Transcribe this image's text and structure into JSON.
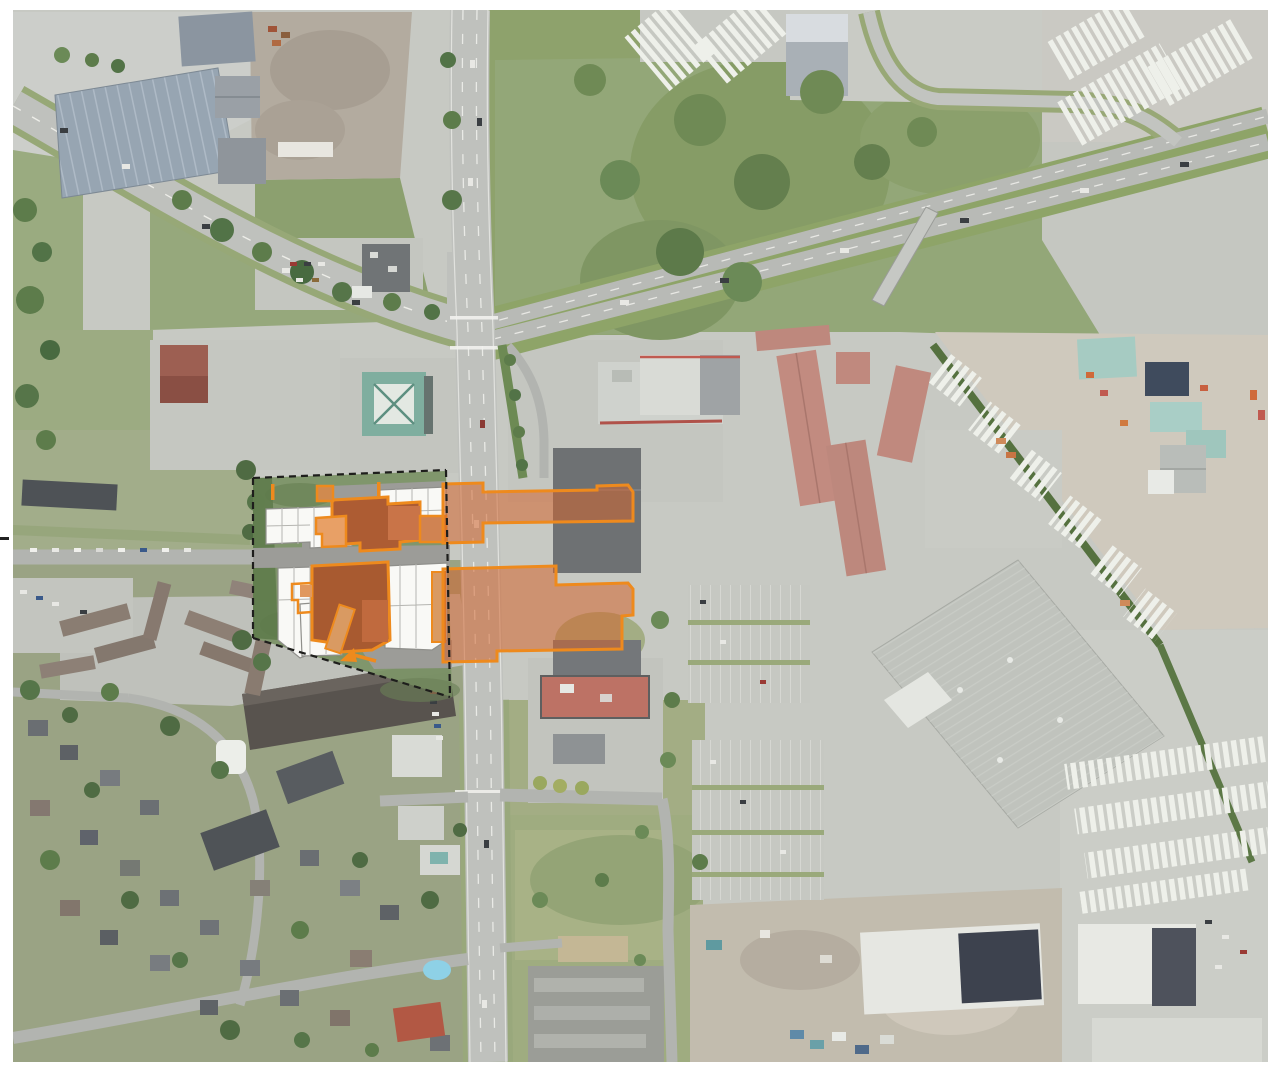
{
  "meta": {
    "description": "Aerial photograph of a suburban arterial corridor with an architectural site-plan overlay: a dashed black site boundary on the west side of a north-south boulevard containing white proposed buildings on a green landscaped site with dark terracotta building masses outlined in orange, plus two semi-transparent orange impact overlays extending east across the boulevard over existing commercial buildings, and an orange locator arrow.",
    "image_type": "aerial-site-plan-composite",
    "visible_text": "none"
  },
  "frame": {
    "margin_color": "#ffffff",
    "photo_area": {
      "x": 13,
      "y": 10,
      "width": 1255,
      "height": 1052
    },
    "crop_mark": {
      "position": "left-edge",
      "color": "#222222"
    }
  },
  "palette": {
    "photo_base": "#c7c9c3",
    "road_asphalt": "#bfc1bd",
    "highway_asphalt": "#b8bab6",
    "lane_marking": "#f4f4f0",
    "green_field": "#93a778",
    "green_scrub": "#859c69",
    "tree_dark": "#5d7a4a",
    "dirt_lot": "#b3ab9f",
    "concrete_yard": "#cfc9bd",
    "roof_red": "#c28b80",
    "roof_dark": "#6e7173",
    "roof_blue_gray": "#97a5b2",
    "roof_teal": "#7fae9f",
    "warehouse_gray": "#c0c3bd",
    "white_roof": "#e8e9e4",
    "residential_roof": "#8a7d72",
    "big_box_red": "#bd7265",
    "pool_blue": "#8ed1e6"
  },
  "site_overlay": {
    "outline_color": "#ee8a1d",
    "boundary_color": "#1e1e1c",
    "boundary_style": "dashed",
    "lawn_color": "#7c9367",
    "drive_color": "#9c9c98",
    "building_white": "#f9f9f6",
    "mass_dark": "#ad5c33",
    "mass_medium": "#c97448",
    "mass_light": "#d99a62",
    "impact_fill": "#d2642d",
    "impact_opacity": 0.55,
    "elements": [
      "site-boundary-dashed",
      "site-lawn",
      "internal-drives",
      "proposed-building-northwest",
      "proposed-building-northeast",
      "proposed-building-southwest",
      "proposed-building-southeast",
      "terracotta-mass-north",
      "terracotta-mass-south",
      "impact-overlay-north",
      "impact-overlay-south",
      "overlay-arrow"
    ]
  },
  "scene_features": [
    "curved-arterial-northwest",
    "north-south-boulevard",
    "divided-highway-northeast",
    "pedestrian-overpass",
    "vacant-dirt-lot",
    "industrial-red-roof-rows",
    "large-warehouse",
    "trailer-yards",
    "residential-neighborhood-southwest",
    "construction-area-south",
    "big-box-store",
    "strip-mall"
  ]
}
